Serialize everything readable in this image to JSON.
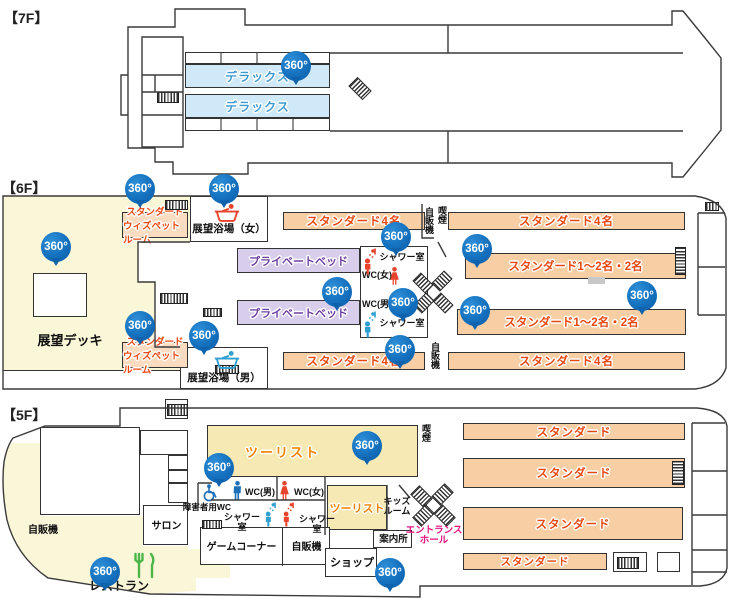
{
  "app": {
    "badge_label": "360°"
  },
  "colors": {
    "badge_blue": "#1470bd",
    "room_orange_fill": "#f8cfa4",
    "room_text_red": "#e8470f",
    "pet_room_fill": "#fcdcc0",
    "private_bed_fill": "#d9cdec",
    "private_bed_text": "#6b3fa0",
    "deluxe_fill": "#cfe9f8",
    "deluxe_text": "#3d9ad1",
    "deck_yellow": "#faf6d8",
    "tourist_fill": "#f6e9b4",
    "tourist_text": "#f08300",
    "entrance_pink": "#e5117f",
    "icon_blue": "#1d6fb8",
    "icon_red": "#e8432c",
    "icon_green": "#4cb748"
  },
  "floors": {
    "f7": {
      "label": "【7F】",
      "deluxe": "デラックス"
    },
    "f6": {
      "label": "【6F】",
      "deck": "展望デッキ",
      "pet_line1": "スタンダード",
      "pet_line2": "ウィズペットルーム",
      "bath_women": "展望浴場（女）",
      "bath_men": "展望浴場（男）",
      "private_bed": "プライベートベッド",
      "std4": "スタンダード4名",
      "std12": "スタンダード1～2名・2名",
      "shower": "シャワー室",
      "wc_women": "WC(女)",
      "wc_men": "WC(男)",
      "vending": "自販機",
      "smoking": "喫煙"
    },
    "f5": {
      "label": "【5F】",
      "tourist": "ツーリスト",
      "standard": "スタンダード",
      "kids_line1": "キッズ",
      "kids_line2": "ルーム",
      "info": "案内所",
      "entrance_line1": "エントランス",
      "entrance_line2": "ホール",
      "salon": "サロン",
      "accessible_wc": "障害者用WC",
      "game": "ゲームコーナー",
      "shop": "ショップ",
      "restaurant": "レストラン",
      "vending": "自販機",
      "smoking": "喫煙",
      "shower": "シャワー室",
      "wc_women": "WC(女)",
      "wc_men": "WC(男)"
    }
  }
}
